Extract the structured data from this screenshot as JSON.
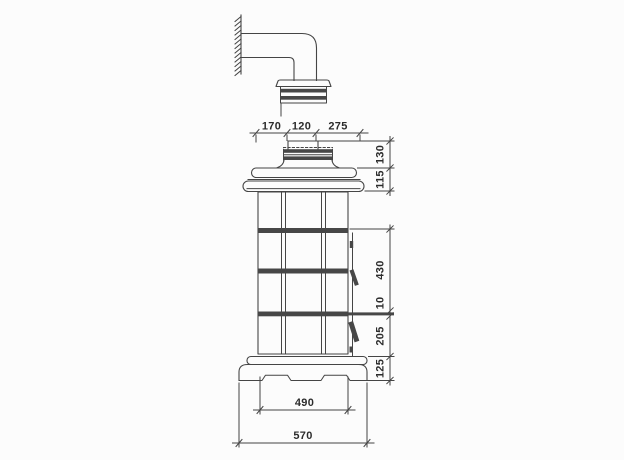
{
  "drawing": {
    "kind": "dimensioned technical elevation",
    "colors": {
      "background": "#fcfcfc",
      "line": "#454545",
      "band_fill": "#474747",
      "label": "#2c2c2c"
    }
  },
  "dimensions": {
    "top": [
      "170",
      "120",
      "275"
    ],
    "right_upper": [
      "130",
      "115"
    ],
    "right_lower": [
      "430",
      "10",
      "205",
      "125"
    ],
    "bottom_inner": "490",
    "bottom_outer": "570"
  }
}
